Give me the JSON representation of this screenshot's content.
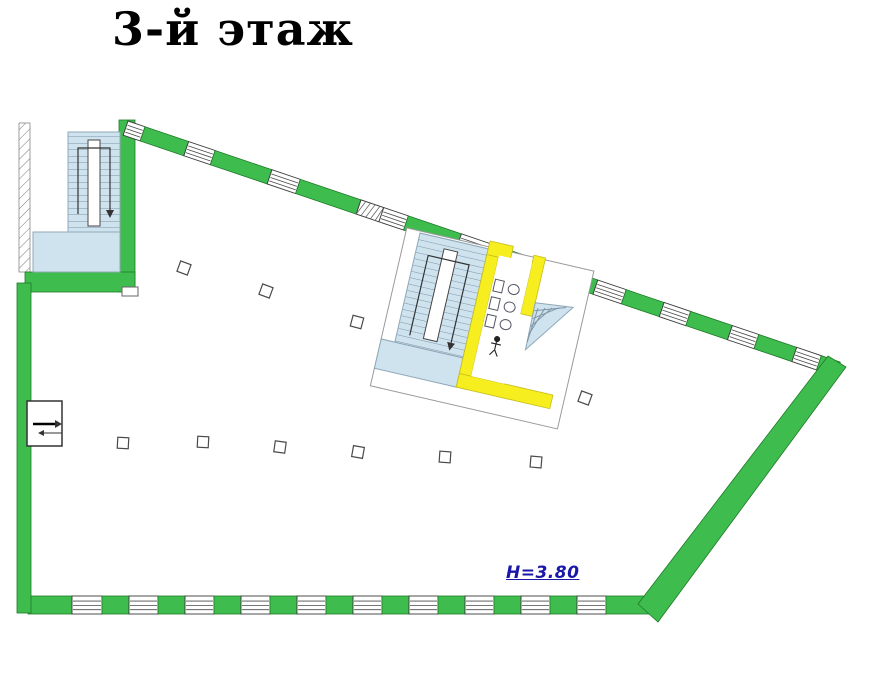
{
  "title": "3-й этаж",
  "height_label": "H=3.80",
  "colors": {
    "wall_green": "#3ebd4e",
    "wall_green_outline": "#1e7a28",
    "stairs_blue": "#cfe3ef",
    "wc_wall_yellow": "#f6ee1e",
    "window_line": "#4a4a4a",
    "height_label_blue": "#1a18a6",
    "title_black": "#000000"
  },
  "walls": {
    "top": {
      "x": 128,
      "y": 121,
      "angle": 18.7,
      "thickness": 15,
      "length": 752,
      "segments": "w18 g46 w28 g60 w30 g64 h24 w26 g56 w30 g40 w26 g48 w30 g40 w28 g44 w28 g40 w26 g40"
    },
    "bottom": {
      "x": 28,
      "y": 596,
      "angle": 0,
      "thickness": 18,
      "length": 624,
      "segments": "g44 w30 g27 w29 g27 w29 g27 w29 g27 w29 g27 w29 g27 w29 g27 w29 g27 w29 g27 w29 g46"
    }
  },
  "columns": [
    {
      "x": 184,
      "y": 268,
      "r": 20
    },
    {
      "x": 266,
      "y": 291,
      "r": 20
    },
    {
      "x": 357,
      "y": 322,
      "r": 15
    },
    {
      "x": 123,
      "y": 443,
      "r": 3
    },
    {
      "x": 203,
      "y": 442,
      "r": 3
    },
    {
      "x": 280,
      "y": 447,
      "r": 8
    },
    {
      "x": 358,
      "y": 452,
      "r": 10
    },
    {
      "x": 445,
      "y": 457,
      "r": 4
    },
    {
      "x": 536,
      "y": 462,
      "r": 5
    },
    {
      "x": 585,
      "y": 398,
      "r": 20
    }
  ],
  "central": {
    "fixture_rows": [
      34,
      52,
      70
    ],
    "winder": {
      "x1": 128,
      "y1": 42,
      "x2": 166,
      "y2": 38,
      "ax": 129,
      "ay": 90,
      "steps": 6
    }
  }
}
